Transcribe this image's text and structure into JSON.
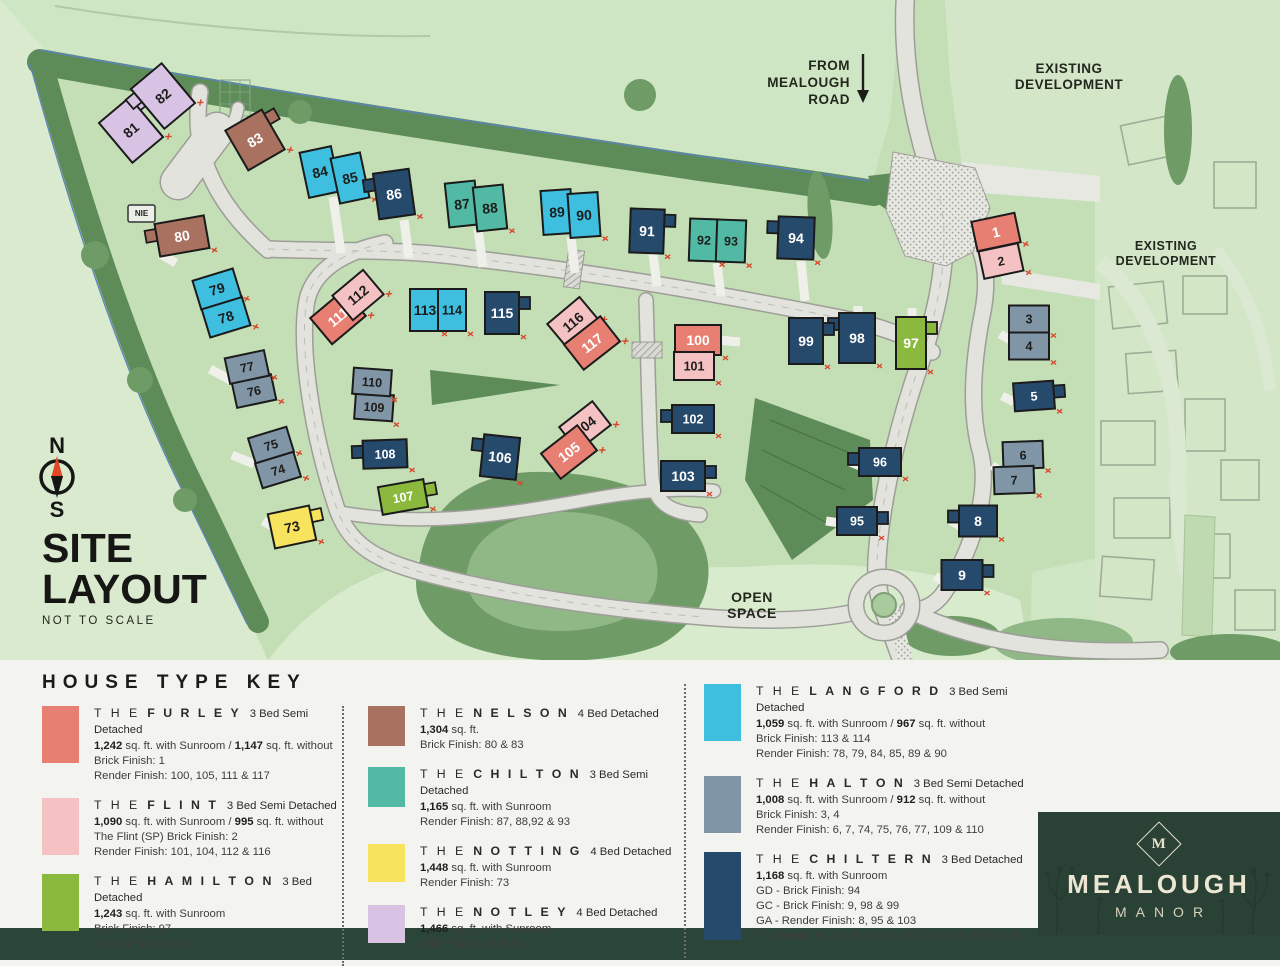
{
  "title_block": {
    "line1": "SITE",
    "line2": "LAYOUT",
    "subtitle": "NOT TO SCALE"
  },
  "compass": {
    "north": "N",
    "south": "S"
  },
  "map_labels": {
    "from_road": [
      "FROM",
      "MEALOUGH",
      "ROAD"
    ],
    "existing_dev_top": [
      "EXISTING",
      "DEVELOPMENT"
    ],
    "existing_dev_right": [
      "EXISTING",
      "DEVELOPMENT"
    ],
    "open_space": [
      "OPEN",
      "SPACE"
    ],
    "nie": "NIE"
  },
  "colors": {
    "outside_green": "#CFE6C4",
    "west_outside_green": "#D9EACE",
    "site_green": "#C4DEB6",
    "existing_green": "#D3E7C8",
    "open_space_green": "#D8EBCD",
    "tree_dark": "#5E8C58",
    "tree_mid": "#6F9B66",
    "hill_light": "#8FB886",
    "road_fill": "#E3E3DD",
    "road_edge": "#9E9E99",
    "drive_white": "#F0F0EA",
    "house_border": "#1B1B1B",
    "red_tick": "#D9472B",
    "boundary_blue": "#5B84B8",
    "label_ink": "#23281F",
    "legend_bg": "#F3F3F0",
    "footer_green": "#2B4538",
    "logo_panel_green": "#2A4136",
    "logo_cream": "#EDE6D3"
  },
  "house_types": {
    "furley": {
      "color": "#E87F73",
      "ink": "#FFFFFF",
      "detached": false
    },
    "flint": {
      "color": "#F5C2C4",
      "ink": "#1D1D1B",
      "detached": false
    },
    "hamilton": {
      "color": "#8BB93E",
      "ink": "#FFFFFF",
      "detached": true
    },
    "nelson": {
      "color": "#A9715F",
      "ink": "#FFFFFF",
      "detached": true
    },
    "chilton": {
      "color": "#52BAA4",
      "ink": "#1D1D1B",
      "detached": false
    },
    "notting": {
      "color": "#F8E35E",
      "ink": "#1D1D1B",
      "detached": true
    },
    "notley": {
      "color": "#D9C3E5",
      "ink": "#1D1D1B",
      "detached": true
    },
    "langford": {
      "color": "#3FBFE0",
      "ink": "#1D1D1B",
      "detached": false
    },
    "halton": {
      "color": "#8095A5",
      "ink": "#1D1D1B",
      "detached": false
    },
    "chiltern": {
      "color": "#264A6B",
      "ink": "#FFFFFF",
      "detached": true
    }
  },
  "plots": [
    {
      "n": "1",
      "t": "furley",
      "x": 996,
      "y": 232,
      "w": 44,
      "h": 30,
      "r": -12
    },
    {
      "n": "2",
      "t": "flint",
      "x": 1001,
      "y": 261,
      "w": 40,
      "h": 28,
      "r": -12
    },
    {
      "n": "3",
      "t": "halton",
      "x": 1029,
      "y": 319,
      "w": 40,
      "h": 27,
      "r": 0
    },
    {
      "n": "4",
      "t": "halton",
      "x": 1029,
      "y": 346,
      "w": 40,
      "h": 27,
      "r": 0
    },
    {
      "n": "5",
      "t": "chiltern",
      "x": 1034,
      "y": 396,
      "w": 40,
      "h": 28,
      "r": -4
    },
    {
      "n": "6",
      "t": "halton",
      "x": 1023,
      "y": 455,
      "w": 40,
      "h": 27,
      "r": -2
    },
    {
      "n": "7",
      "t": "halton",
      "x": 1014,
      "y": 480,
      "w": 40,
      "h": 27,
      "r": -2
    },
    {
      "n": "8",
      "t": "chiltern",
      "x": 978,
      "y": 521,
      "w": 38,
      "h": 31,
      "r": 0
    },
    {
      "n": "9",
      "t": "chiltern",
      "x": 962,
      "y": 575,
      "w": 41,
      "h": 30,
      "r": 0
    },
    {
      "n": "73",
      "t": "notting",
      "x": 292,
      "y": 527,
      "w": 42,
      "h": 35,
      "r": -12
    },
    {
      "n": "74",
      "t": "halton",
      "x": 278,
      "y": 470,
      "w": 40,
      "h": 26,
      "r": -17
    },
    {
      "n": "75",
      "t": "halton",
      "x": 271,
      "y": 445,
      "w": 40,
      "h": 26,
      "r": -17
    },
    {
      "n": "76",
      "t": "halton",
      "x": 254,
      "y": 391,
      "w": 40,
      "h": 26,
      "r": -12
    },
    {
      "n": "77",
      "t": "halton",
      "x": 247,
      "y": 367,
      "w": 40,
      "h": 26,
      "r": -12
    },
    {
      "n": "78",
      "t": "langford",
      "x": 226,
      "y": 317,
      "w": 42,
      "h": 30,
      "r": -17
    },
    {
      "n": "79",
      "t": "langford",
      "x": 217,
      "y": 289,
      "w": 42,
      "h": 30,
      "r": -17
    },
    {
      "n": "80",
      "t": "nelson",
      "x": 182,
      "y": 236,
      "w": 50,
      "h": 33,
      "r": -10
    },
    {
      "n": "81",
      "t": "notley",
      "x": 131,
      "y": 130,
      "w": 40,
      "h": 52,
      "r": -40
    },
    {
      "n": "82",
      "t": "notley",
      "x": 163,
      "y": 96,
      "w": 40,
      "h": 52,
      "r": -40
    },
    {
      "n": "83",
      "t": "nelson",
      "x": 255,
      "y": 140,
      "w": 42,
      "h": 46,
      "r": -30
    },
    {
      "n": "84",
      "t": "langford",
      "x": 320,
      "y": 172,
      "w": 32,
      "h": 46,
      "r": -12
    },
    {
      "n": "85",
      "t": "langford",
      "x": 350,
      "y": 178,
      "w": 30,
      "h": 46,
      "r": -12
    },
    {
      "n": "86",
      "t": "chiltern",
      "x": 394,
      "y": 194,
      "w": 36,
      "h": 46,
      "r": -8
    },
    {
      "n": "87",
      "t": "chilton",
      "x": 462,
      "y": 204,
      "w": 30,
      "h": 44,
      "r": -6
    },
    {
      "n": "88",
      "t": "chilton",
      "x": 490,
      "y": 208,
      "w": 30,
      "h": 44,
      "r": -6
    },
    {
      "n": "89",
      "t": "langford",
      "x": 557,
      "y": 212,
      "w": 30,
      "h": 44,
      "r": -4
    },
    {
      "n": "90",
      "t": "langford",
      "x": 584,
      "y": 215,
      "w": 30,
      "h": 44,
      "r": -4
    },
    {
      "n": "91",
      "t": "chiltern",
      "x": 647,
      "y": 231,
      "w": 34,
      "h": 44,
      "r": 2
    },
    {
      "n": "92",
      "t": "chilton",
      "x": 704,
      "y": 240,
      "w": 29,
      "h": 42,
      "r": 2
    },
    {
      "n": "93",
      "t": "chilton",
      "x": 731,
      "y": 241,
      "w": 29,
      "h": 42,
      "r": 2
    },
    {
      "n": "94",
      "t": "chiltern",
      "x": 796,
      "y": 238,
      "w": 36,
      "h": 42,
      "r": 2
    },
    {
      "n": "95",
      "t": "chiltern",
      "x": 857,
      "y": 521,
      "w": 40,
      "h": 28,
      "r": 0
    },
    {
      "n": "96",
      "t": "chiltern",
      "x": 880,
      "y": 462,
      "w": 42,
      "h": 28,
      "r": 0
    },
    {
      "n": "97",
      "t": "hamilton",
      "x": 911,
      "y": 343,
      "w": 30,
      "h": 52,
      "r": 0
    },
    {
      "n": "98",
      "t": "chiltern",
      "x": 857,
      "y": 338,
      "w": 36,
      "h": 50,
      "r": 0
    },
    {
      "n": "99",
      "t": "chiltern",
      "x": 806,
      "y": 341,
      "w": 34,
      "h": 46,
      "r": 0
    },
    {
      "n": "100",
      "t": "furley",
      "x": 698,
      "y": 340,
      "w": 46,
      "h": 30,
      "r": 0
    },
    {
      "n": "101",
      "t": "flint",
      "x": 694,
      "y": 366,
      "w": 40,
      "h": 28,
      "r": 0
    },
    {
      "n": "102",
      "t": "chiltern",
      "x": 693,
      "y": 419,
      "w": 42,
      "h": 28,
      "r": 0
    },
    {
      "n": "103",
      "t": "chiltern",
      "x": 683,
      "y": 476,
      "w": 44,
      "h": 30,
      "r": 0
    },
    {
      "n": "104",
      "t": "flint",
      "x": 585,
      "y": 426,
      "w": 42,
      "h": 30,
      "r": -38
    },
    {
      "n": "105",
      "t": "furley",
      "x": 569,
      "y": 452,
      "w": 46,
      "h": 32,
      "r": -38
    },
    {
      "n": "106",
      "t": "chiltern",
      "x": 500,
      "y": 457,
      "w": 36,
      "h": 42,
      "r": 6
    },
    {
      "n": "107",
      "t": "hamilton",
      "x": 403,
      "y": 497,
      "w": 46,
      "h": 28,
      "r": -10
    },
    {
      "n": "108",
      "t": "chiltern",
      "x": 385,
      "y": 454,
      "w": 44,
      "h": 28,
      "r": -2
    },
    {
      "n": "109",
      "t": "halton",
      "x": 374,
      "y": 407,
      "w": 38,
      "h": 26,
      "r": 4
    },
    {
      "n": "110",
      "t": "halton",
      "x": 372,
      "y": 382,
      "w": 38,
      "h": 26,
      "r": 4
    },
    {
      "n": "111",
      "t": "furley",
      "x": 338,
      "y": 317,
      "w": 44,
      "h": 34,
      "r": -40
    },
    {
      "n": "112",
      "t": "flint",
      "x": 358,
      "y": 295,
      "w": 40,
      "h": 32,
      "r": -40
    },
    {
      "n": "113",
      "t": "langford",
      "x": 425,
      "y": 310,
      "w": 30,
      "h": 42,
      "r": 0
    },
    {
      "n": "114",
      "t": "langford",
      "x": 452,
      "y": 310,
      "w": 28,
      "h": 42,
      "r": 0
    },
    {
      "n": "115",
      "t": "chiltern",
      "x": 502,
      "y": 313,
      "w": 34,
      "h": 42,
      "r": 0
    },
    {
      "n": "116",
      "t": "flint",
      "x": 573,
      "y": 322,
      "w": 42,
      "h": 30,
      "r": -40
    },
    {
      "n": "117",
      "t": "furley",
      "x": 592,
      "y": 343,
      "w": 46,
      "h": 32,
      "r": -38
    }
  ],
  "legend": {
    "heading": "HOUSE TYPE KEY",
    "columns": [
      [
        {
          "type": "furley",
          "the": "T H E",
          "name": "FURLEY",
          "desc": "3 Bed Semi Detached",
          "sh": 57,
          "lines": [
            "1,242 sq. ft. with Sunroom / 1,147 sq. ft. without",
            "Brick Finish: 1",
            "Render Finish: 100, 105, 111 & 117"
          ]
        },
        {
          "type": "flint",
          "the": "T H E",
          "name": "FLINT",
          "desc": "3 Bed Semi Detached",
          "sh": 57,
          "lines": [
            "1,090 sq. ft. with Sunroom / 995 sq. ft. without",
            "The Flint (SP) Brick Finish: 2",
            "Render Finish: 101, 104, 112 & 116"
          ]
        },
        {
          "type": "hamilton",
          "the": "T H E",
          "name": "HAMILTON",
          "desc": "3 Bed Detached",
          "sh": 57,
          "lines": [
            "1,243 sq. ft. with Sunroom",
            "Brick Finish: 97",
            "Render Finish: 107"
          ]
        }
      ],
      [
        {
          "type": "nelson",
          "the": "T H E",
          "name": "NELSON",
          "desc": "4 Bed Detached",
          "sh": 40,
          "lines": [
            "1,304 sq. ft.",
            "Brick Finish: 80 & 83"
          ]
        },
        {
          "type": "chilton",
          "the": "T H E",
          "name": "CHILTON",
          "desc": "3 Bed Semi Detached",
          "sh": 40,
          "lines": [
            "1,165 sq. ft. with Sunroom",
            "Render Finish: 87, 88,92 & 93"
          ]
        },
        {
          "type": "notting",
          "the": "T H E",
          "name": "NOTTING",
          "desc": "4 Bed Detached",
          "sh": 38,
          "lines": [
            "1,448 sq. ft. with Sunroom",
            "Render Finish: 73"
          ]
        },
        {
          "type": "notley",
          "the": "T H E",
          "name": "NOTLEY",
          "desc": "4 Bed Detached",
          "sh": 38,
          "lines": [
            "1,466 sq. ft. with Sunroom",
            "Brick Finish: 81 & 82"
          ]
        }
      ],
      [
        {
          "type": "langford",
          "the": "T H E",
          "name": "LANGFORD",
          "desc": "3 Bed Semi Detached",
          "sh": 57,
          "lines": [
            "1,059 sq. ft. with Sunroom / 967 sq. ft. without",
            "Brick Finish: 113 & 114",
            "Render Finish: 78, 79, 84, 85, 89 & 90"
          ]
        },
        {
          "type": "halton",
          "the": "T H E",
          "name": "HALTON",
          "desc": "3 Bed Semi Detached",
          "sh": 57,
          "lines": [
            "1,008 sq. ft. with Sunroom / 912 sq. ft. without",
            "Brick Finish: 3, 4",
            "Render Finish: 6, 7, 74, 75, 76, 77, 109 & 110"
          ]
        },
        {
          "type": "chiltern",
          "the": "T H E",
          "name": "CHILTERN",
          "desc": "3 Bed Detached",
          "sh": 88,
          "lines": [
            "1,168 sq. ft. with Sunroom",
            "GD - Brick Finish: 94",
            "GC - Brick Finish: 9, 98 & 99",
            "GA - Render Finish: 8, 95 & 103",
            "G - Render Finish: 5, 86, 91, 96, 102, 106, 108 & 115"
          ]
        }
      ]
    ]
  },
  "logo": {
    "monogram": "M",
    "name": "MEALOUGH",
    "subname": "MANOR"
  }
}
